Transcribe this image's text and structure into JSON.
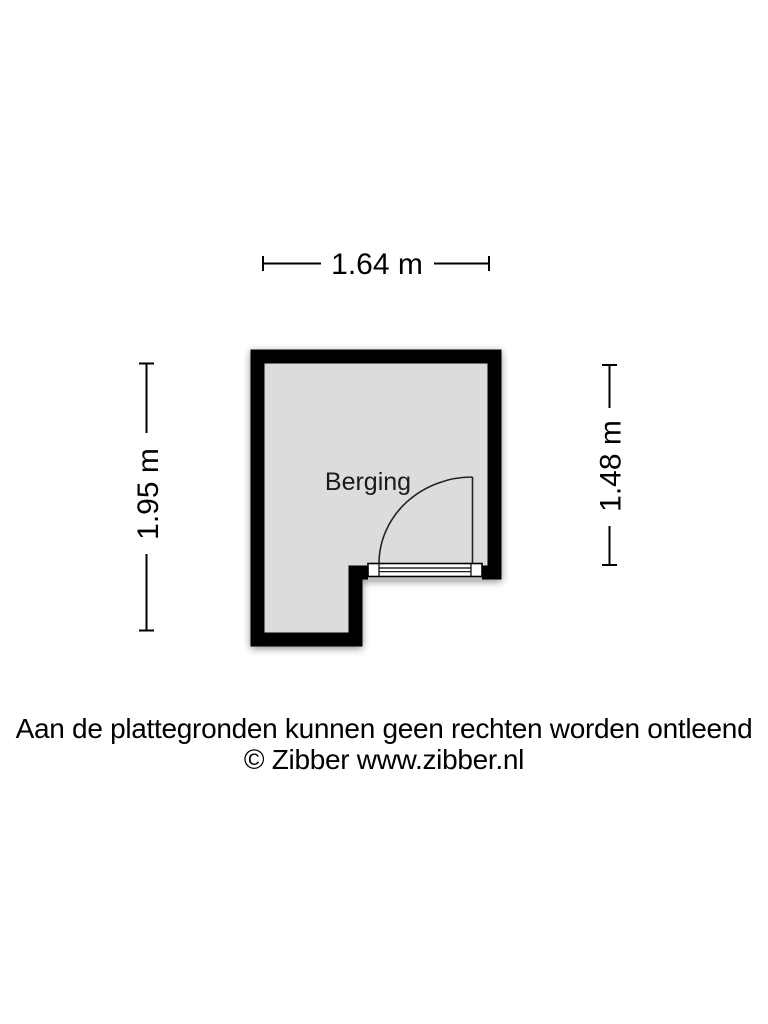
{
  "floorplan": {
    "room": {
      "label": "Berging"
    },
    "dimensions": {
      "top": "1.64 m",
      "left": "1.95 m",
      "right": "1.48 m"
    },
    "colors": {
      "wall": "#000000",
      "floor": "#dcdcdc",
      "background": "#ffffff",
      "text": "#000000"
    }
  },
  "footer": {
    "disclaimer": "Aan de plattegronden kunnen geen rechten worden ontleend",
    "copyright": "© Zibber www.zibber.nl"
  }
}
